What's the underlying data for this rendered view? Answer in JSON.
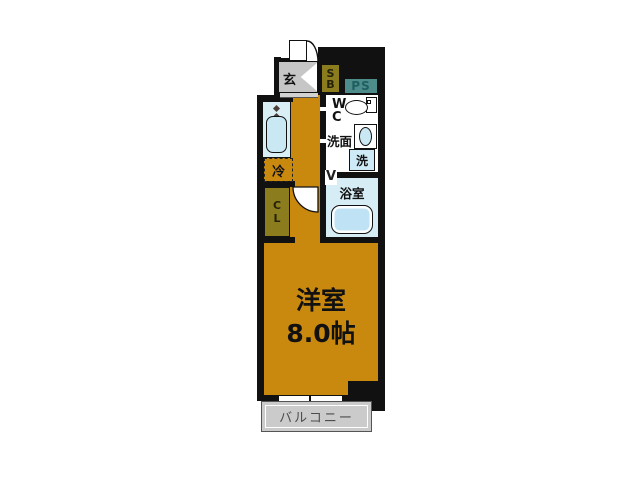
{
  "floor_plan": {
    "entrance": {
      "label": "玄"
    },
    "shoe_box": {
      "line1": "S",
      "line2": "B"
    },
    "pipe_shaft": {
      "label": "PS"
    },
    "toilet": {
      "line1": "W",
      "line2": "C"
    },
    "washstand": {
      "label": "洗面"
    },
    "washer": {
      "label": "洗"
    },
    "bathroom": {
      "label": "浴室",
      "door_mark": "V"
    },
    "refrigerator": {
      "label": "冷"
    },
    "closet": {
      "line1": "C",
      "line2": "L"
    },
    "main_room": {
      "name": "洋室",
      "size": "8.0帖"
    },
    "balcony": {
      "label": "バルコニー"
    },
    "colors": {
      "floor_orange": "#C9880E",
      "wall_black": "#111111",
      "storage_olive": "#8B7D1E",
      "pipe_teal": "#4E8C8C",
      "wet_area_blue": "#D6EDF6",
      "tub_blue": "#BFE3F4",
      "balcony_gray": "#CBCBCB"
    }
  }
}
